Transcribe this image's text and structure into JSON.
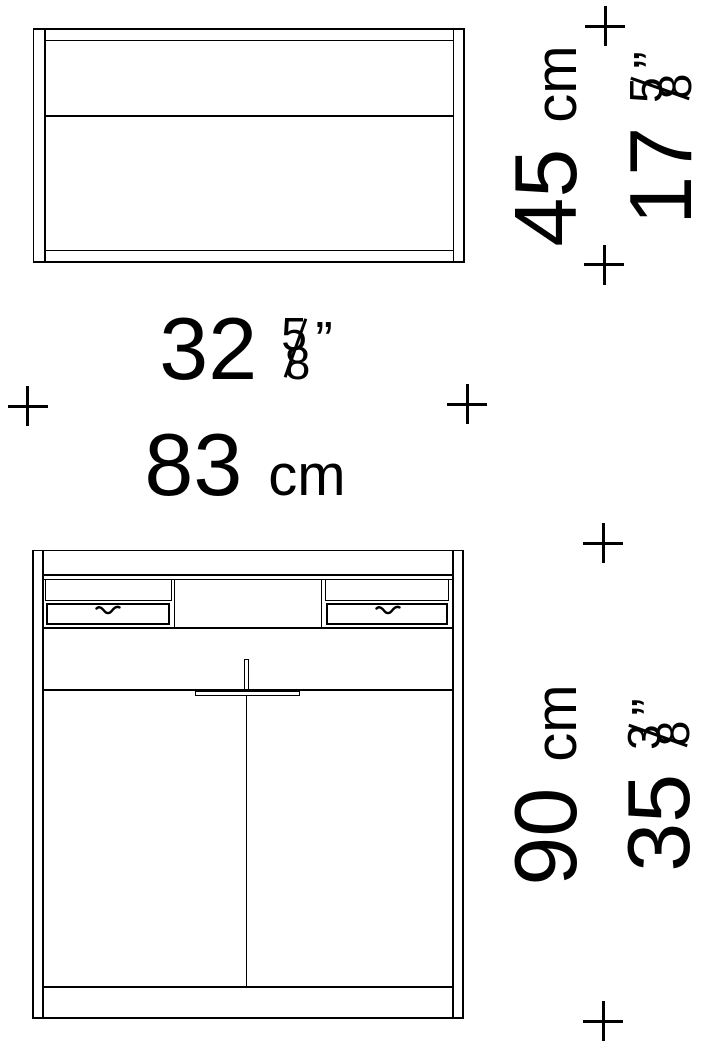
{
  "dimensions": {
    "depth": {
      "cm": "45",
      "unit": "cm",
      "inches": "17",
      "frac_num": "5",
      "frac_den": "8",
      "prime": "”"
    },
    "width": {
      "inches": "32",
      "frac_num": "5",
      "frac_den": "8",
      "prime": "”",
      "cm": "83",
      "unit": "cm"
    },
    "height": {
      "cm": "90",
      "unit": "cm",
      "inches": "35",
      "frac_num": "3",
      "frac_den": "8",
      "prime": "”"
    }
  },
  "colors": {
    "line": "#000000",
    "background": "#ffffff"
  }
}
